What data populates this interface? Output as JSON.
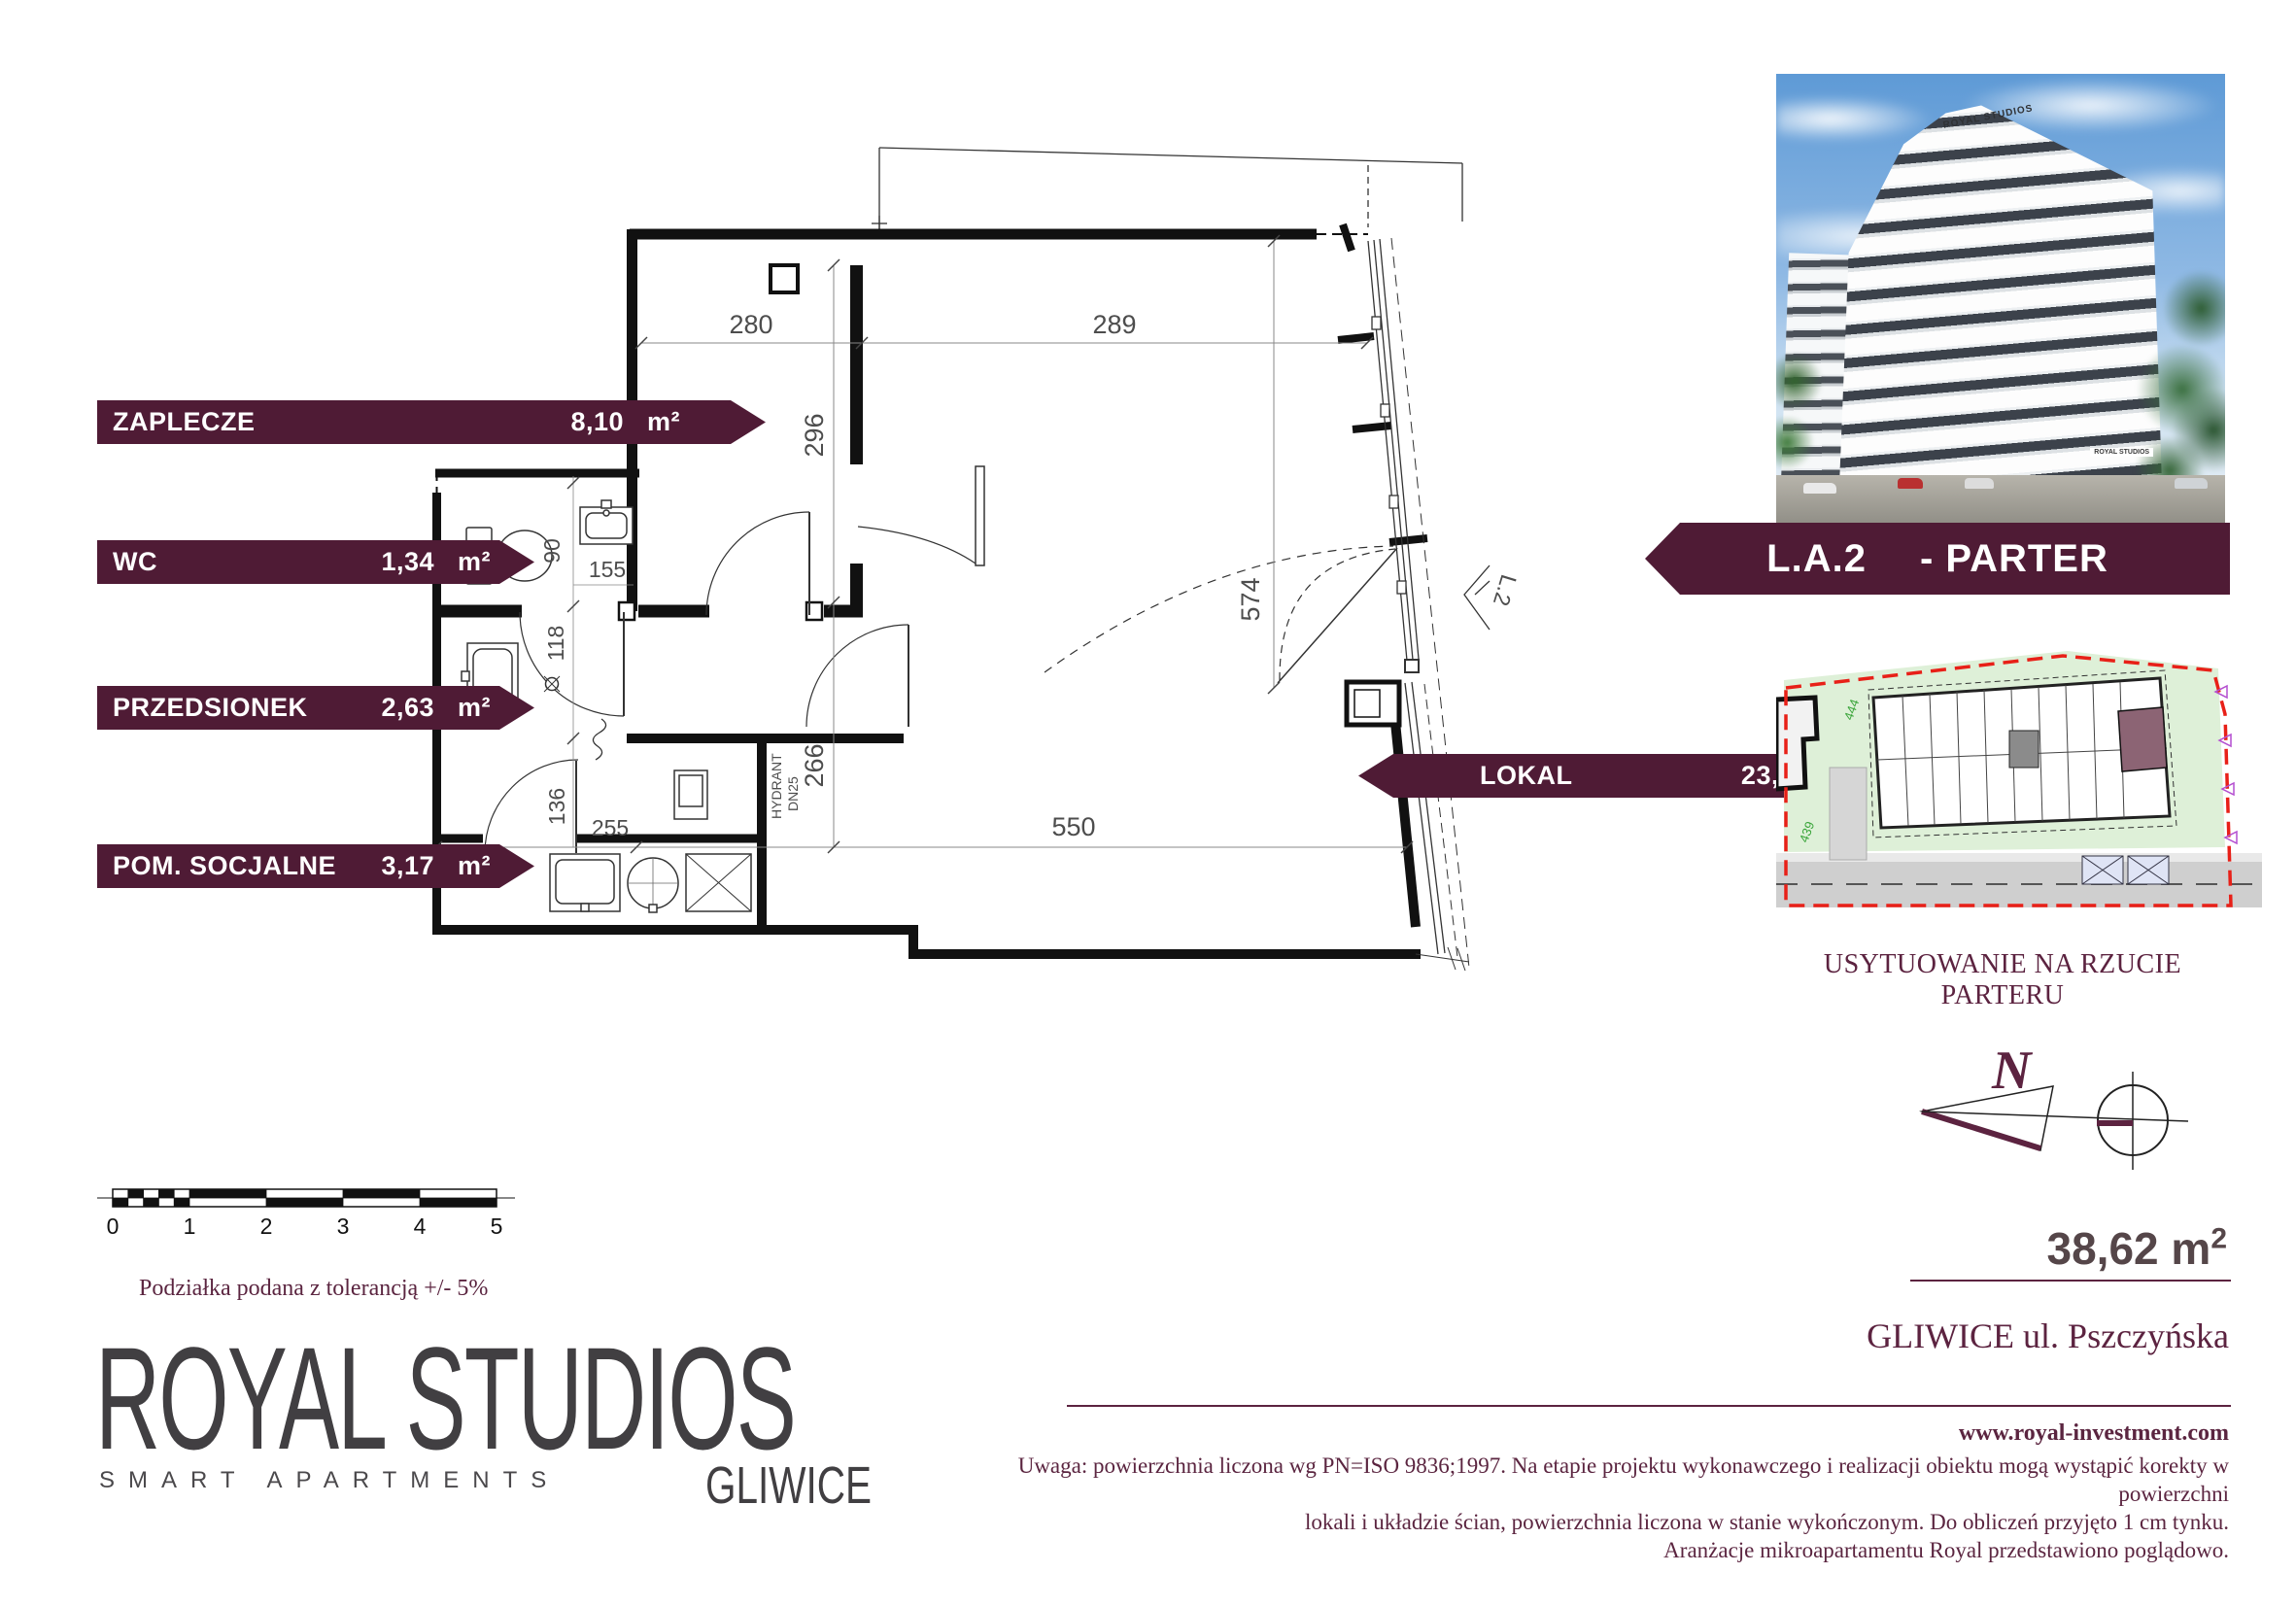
{
  "rooms": [
    {
      "label": "ZAPLECZE",
      "area": "8,10",
      "unit": "m²"
    },
    {
      "label": "WC",
      "area": "1,34",
      "unit": "m²"
    },
    {
      "label": "PRZEDSIONEK",
      "area": "2,63",
      "unit": "m²"
    },
    {
      "label": "POM. SOCJALNE",
      "area": "3,17",
      "unit": "m²"
    },
    {
      "label": "LOKAL",
      "area": "23,38",
      "unit": "m²"
    }
  ],
  "unit_banner": {
    "code": "L.A.2",
    "floor": "- PARTER"
  },
  "plan": {
    "dims": {
      "top_left": "280",
      "top_right": "289",
      "upper_height": "296",
      "right_height": "574",
      "wc_height": "90",
      "wc_width": "155",
      "hall_height": "118",
      "socj_height": "136",
      "socj_width": "255",
      "mid_height": "266",
      "bottom_width": "550"
    },
    "annotations": {
      "hydrant_line1": "HYDRANT",
      "hydrant_line2": "DN25",
      "entrance": "L.2"
    }
  },
  "photo": {
    "sign": "ROYAL STUDIOS"
  },
  "site_plan": {
    "caption": "USYTUOWANIE NA RZUCIE PARTERU",
    "plot_number_1": "444",
    "plot_number_2": "439"
  },
  "north": {
    "label": "N"
  },
  "scale_bar": {
    "ticks": [
      "0",
      "1",
      "2",
      "3",
      "4",
      "5"
    ],
    "tolerance_note": "Podziałka podana z tolerancją +/- 5%"
  },
  "summary": {
    "total_area": "38,62 m",
    "total_area_sup": "2",
    "address": "GLIWICE ul. Pszczyńska",
    "website": "www.royal-investment.com",
    "disclaimer_line1": "Uwaga: powierzchnia liczona wg PN=ISO 9836;1997. Na etapie projektu wykonawczego i realizacji obiektu mogą wystąpić korekty w powierzchni",
    "disclaimer_line2": "lokali i układzie ścian, powierzchnia liczona w stanie wykończonym. Do obliczeń przyjęto 1 cm tynku.",
    "disclaimer_line3": "Aranżacje mikroapartamentu Royal przedstawiono poglądowo."
  },
  "logo": {
    "name": "ROYAL STUDIOS",
    "tagline": "SMART APARTMENTS",
    "city": "GLIWICE"
  }
}
